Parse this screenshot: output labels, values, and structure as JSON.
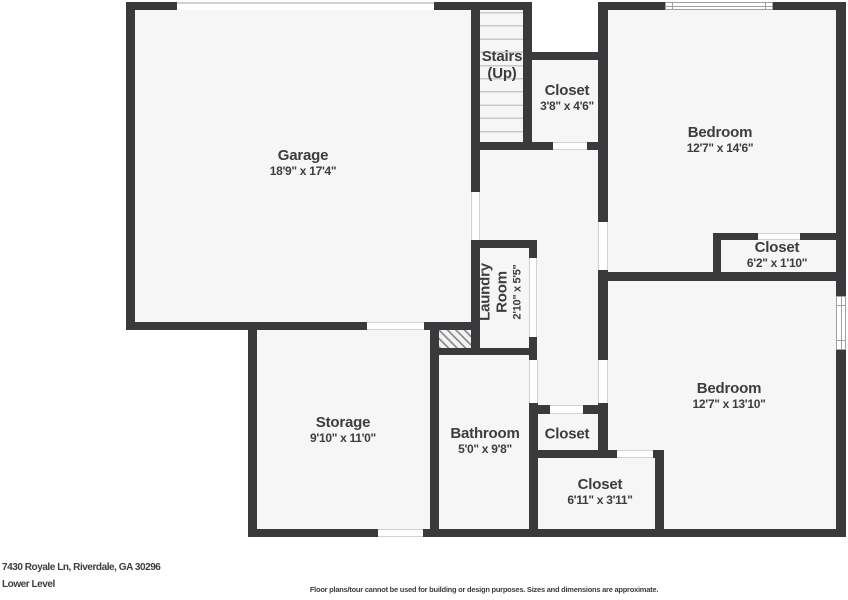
{
  "colors": {
    "wall": "#3a3a3c",
    "floor": "#f6f6f6",
    "background": "#ffffff",
    "text": "#3d3d3f",
    "door_line": "#d2d2d2",
    "window_line": "#a0a0a0",
    "tread_line": "#c9c9c9"
  },
  "rooms": [
    {
      "id": "garage",
      "name": "Garage",
      "dims": "18'9\" x 17'4\"",
      "cx": 303,
      "cy": 163,
      "style": "normal"
    },
    {
      "id": "stairs",
      "name": "Stairs",
      "dims": "(Up)",
      "cx": 502,
      "cy": 65,
      "style": "stairs"
    },
    {
      "id": "closet-upper",
      "name": "Closet",
      "dims": "3'8\" x 4'6\"",
      "cx": 567,
      "cy": 98,
      "style": "normal"
    },
    {
      "id": "bedroom-1",
      "name": "Bedroom",
      "dims": "12'7\" x 14'6\"",
      "cx": 720,
      "cy": 140,
      "style": "normal"
    },
    {
      "id": "closet-bedroom-1",
      "name": "Closet",
      "dims": "6'2\" x 1'10\"",
      "cx": 777,
      "cy": 255,
      "style": "normal"
    },
    {
      "id": "laundry",
      "name": "Laundry Room",
      "dims": "2'10\" x 5'5\"",
      "cx": 501,
      "cy": 292,
      "style": "rotated"
    },
    {
      "id": "storage",
      "name": "Storage",
      "dims": "9'10\" x 11'0\"",
      "cx": 343,
      "cy": 430,
      "style": "normal"
    },
    {
      "id": "bathroom",
      "name": "Bathroom",
      "dims": "5'0\" x 9'8\"",
      "cx": 485,
      "cy": 441,
      "style": "normal"
    },
    {
      "id": "closet-middle",
      "name": "Closet",
      "dims": "",
      "cx": 567,
      "cy": 434,
      "style": "normal"
    },
    {
      "id": "closet-bottom",
      "name": "Closet",
      "dims": "6'11\" x 3'11\"",
      "cx": 600,
      "cy": 492,
      "style": "normal"
    },
    {
      "id": "bedroom-2",
      "name": "Bedroom",
      "dims": "12'7\" x 13'10\"",
      "cx": 729,
      "cy": 396,
      "style": "normal"
    }
  ],
  "footer": {
    "address": "7430 Royale Ln, Riverdale, GA 30296",
    "level": "Lower Level",
    "disclaimer": "Floor plans/tour cannot be used for building or design purposes. Sizes and dimensions are approximate."
  }
}
